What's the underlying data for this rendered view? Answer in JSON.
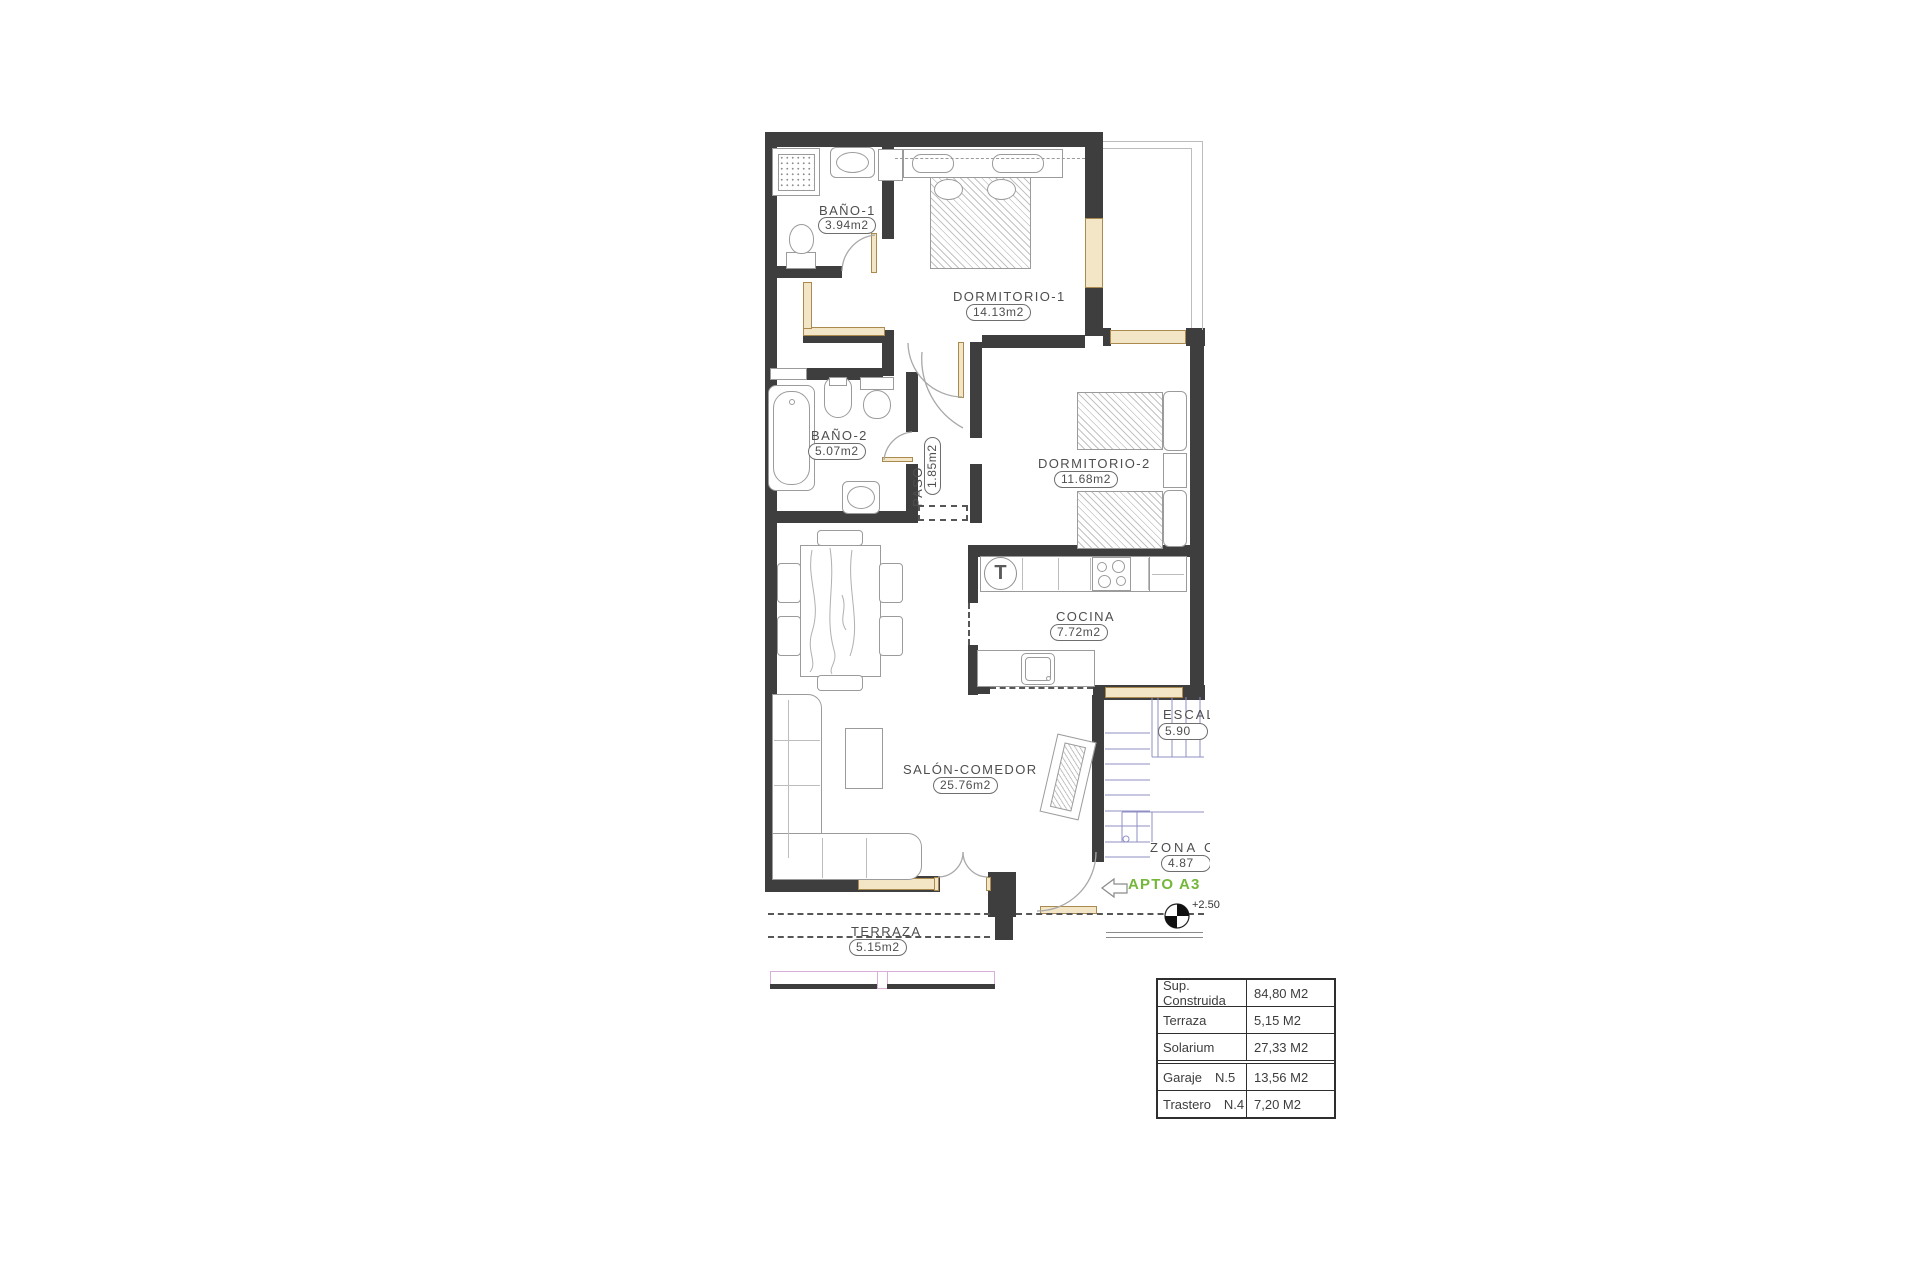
{
  "plan": {
    "rooms": [
      {
        "name": "BAÑO-1",
        "area": "3.94m2"
      },
      {
        "name": "DORMITORIO-1",
        "area": "14.13m2"
      },
      {
        "name": "BAÑO-2",
        "area": "5.07m2"
      },
      {
        "name": "PASO",
        "area": "1.85m2"
      },
      {
        "name": "DORMITORIO-2",
        "area": "11.68m2"
      },
      {
        "name": "COCINA",
        "area": "7.72m2"
      },
      {
        "name": "SALÓN-COMEDOR",
        "area": "25.76m2"
      },
      {
        "name": "TERRAZA",
        "area": "5.15m2"
      },
      {
        "name": "ESCAL",
        "area": "5.90"
      },
      {
        "name": "ZONA C",
        "area": "4.87"
      }
    ],
    "apartment_label": "APTO A3",
    "level_mark": "+2.50",
    "fixtures": {
      "termo": "T"
    },
    "colors": {
      "wall": "#3e3e3e",
      "window_wood": "#f3e6c6",
      "accent_green": "#74b73a",
      "stairs_blue": "#8f8fc6",
      "rail_pink": "#d9aed9"
    }
  },
  "summary_table": {
    "rows": [
      {
        "label": "Sup. Construida",
        "value": "84,80 M2"
      },
      {
        "label": "Terraza",
        "value": "5,15 M2"
      },
      {
        "label": "Solarium",
        "value": "27,33 M2"
      },
      {
        "label": "Garaje",
        "unit_no": "N.5",
        "value": "13,56 M2"
      },
      {
        "label": "Trastero",
        "unit_no": "N.4",
        "value": "7,20 M2"
      }
    ]
  }
}
